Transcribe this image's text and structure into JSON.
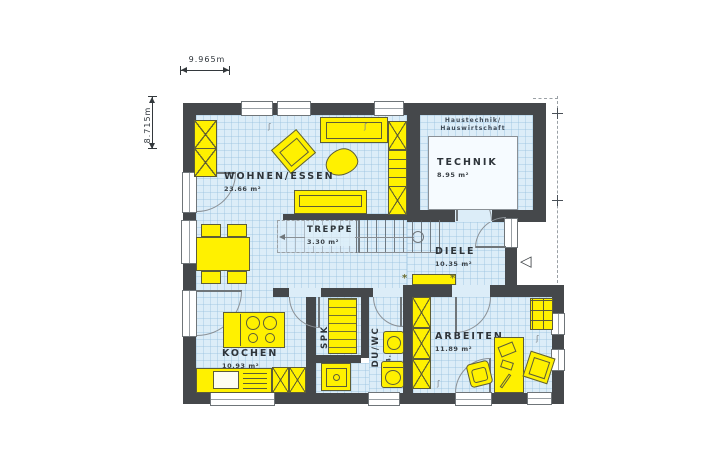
{
  "dimensions": {
    "width": "9.965m",
    "height": "8.715m"
  },
  "rooms": {
    "wohnen": {
      "name": "WOHNEN/ESSEN",
      "area": "23.66 m²"
    },
    "technik": {
      "name": "TECHNIK",
      "area": "8.95 m²",
      "note1": "Haustechnik/",
      "note2": "Hauswirtschaft"
    },
    "treppe": {
      "name": "TREPPE",
      "area": "3.30 m²"
    },
    "diele": {
      "name": "DIELE",
      "area": "10.35 m²"
    },
    "spk": {
      "name": "SPK",
      "area": "1.73 m²"
    },
    "duwc": {
      "name": "DU/WC",
      "area": "4.79 m²"
    },
    "kochen": {
      "name": "KOCHEN",
      "area": "10.93 m²"
    },
    "arbeiten": {
      "name": "ARBEITEN",
      "area": "11.89 m²"
    }
  },
  "icons": {
    "entrance_marker": "◁",
    "plant_marker": "*"
  },
  "colors": {
    "wall": "#45484b",
    "floor": "#dcedf8",
    "grid": "#94becd",
    "furniture": "#fff100",
    "outline": "#5d5d38"
  }
}
